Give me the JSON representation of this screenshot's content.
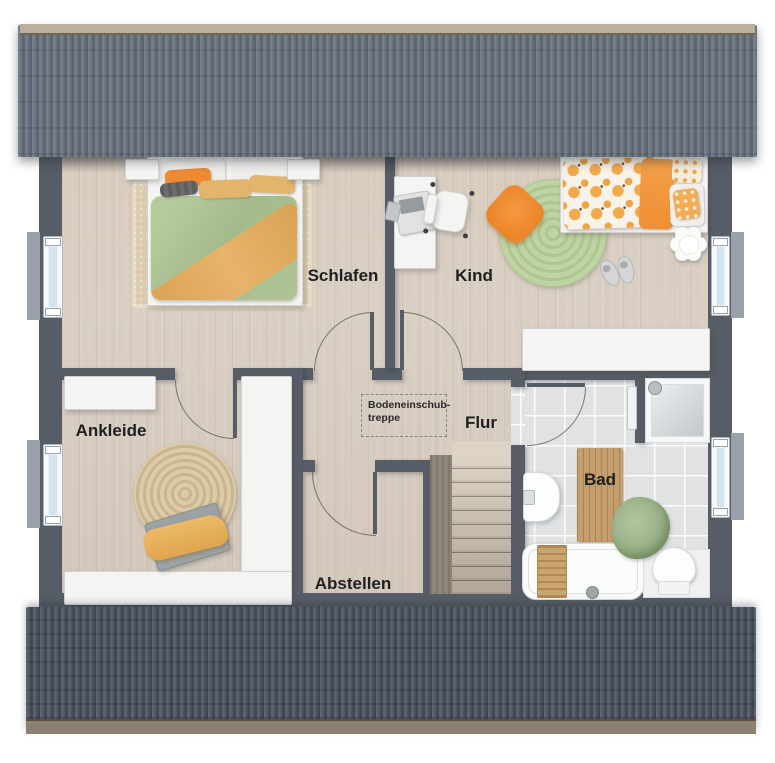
{
  "labels": {
    "schlafen": "Schlafen",
    "kind": "Kind",
    "ankleide": "Ankleide",
    "abstellen": "Abstellen",
    "flur": "Flur",
    "bad": "Bad",
    "attic_hatch_line1": "Bodeneinschub-",
    "attic_hatch_line2": "treppe"
  },
  "colors": {
    "wall": "#575d66",
    "roofTop": "#66707d",
    "roofBottom": "#4e5561",
    "ridge": "#bcb09c",
    "eave": "#8c8071",
    "wood": "#d9cfc3",
    "tile": "#e0e2e4",
    "glass": "#d3e4ee",
    "furn": "#f4f4f3",
    "label": "#1f1f1f",
    "accentOrange": "#ee8c33",
    "accentGreen": "#abc193"
  }
}
